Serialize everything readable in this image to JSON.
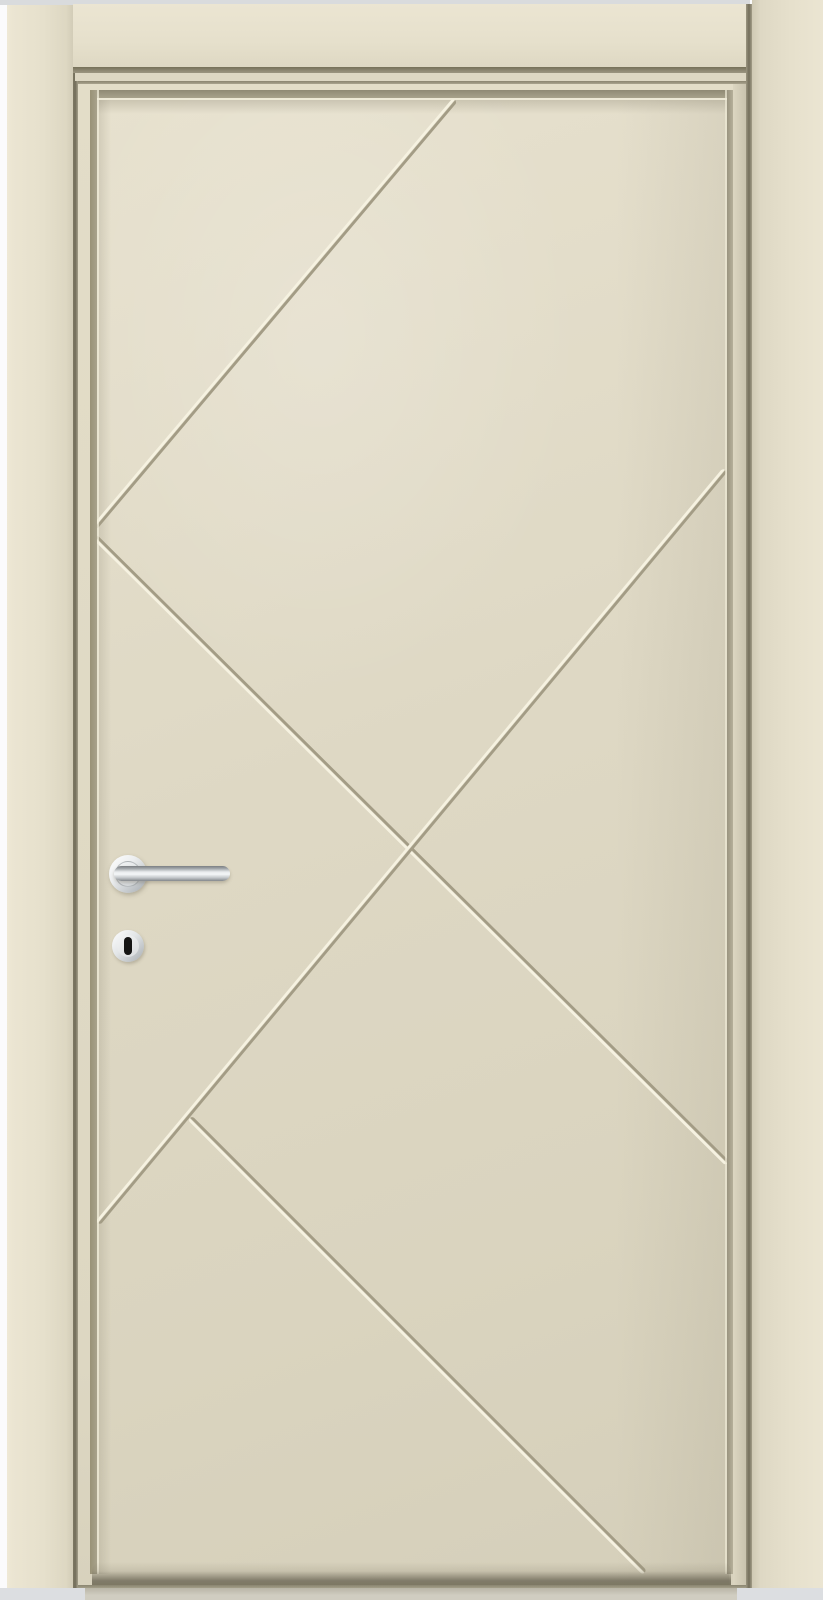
{
  "scene": {
    "description": "Closed ivory-cream painted interior door in matching frame, decorated with incised diagonal V-grooves forming an X pattern, fitted with a round-rose stainless steel lever handle and a round keyhole escutcheon",
    "door_style": "flush slab with recessed field and diagonal pantograph grooves",
    "colors": {
      "background": "#fbfbfc",
      "top_strip": "#d9dbdd",
      "floor_strip": "#dcdee1",
      "floor_under_door": "#d0cdc1",
      "frame_cream": "#e6e0cc",
      "frame_cream_light": "#ebe5d2",
      "frame_cream_dark": "#d2ccb7",
      "door_border": "#e3ddc8",
      "panel_light": "#e7e1ce",
      "panel_mid": "#ded8c4",
      "panel_dark": "#d5cfba",
      "shadow_olive": "#8c8671",
      "seam_dark": "#736e5b",
      "groove_dark": "#a39c85",
      "groove_light": "#f6f2e1",
      "steel_bright": "#f4f6f7",
      "steel_mid": "#c3c8cb",
      "steel_dark": "#7b7f83",
      "keyhole_slot": "#151515"
    },
    "grooves": {
      "width_px": 6,
      "lines": [
        {
          "name": "upper-diagonal",
          "x1": 455,
          "y1": 100,
          "x2": 95,
          "y2": 527
        },
        {
          "name": "main-diagonal",
          "x1": 95,
          "y1": 537,
          "x2": 727,
          "y2": 1163
        },
        {
          "name": "counter-diagonal",
          "x1": 725,
          "y1": 470,
          "x2": 98,
          "y2": 1223
        },
        {
          "name": "lower-diagonal",
          "x1": 190,
          "y1": 1118,
          "x2": 645,
          "y2": 1573
        }
      ],
      "cross_point": {
        "x": 411,
        "y": 850
      }
    },
    "hardware": {
      "finish": "brushed stainless steel",
      "lever_rose_center": {
        "x": 128,
        "y": 874
      },
      "keyhole_center": {
        "x": 128,
        "y": 946
      }
    }
  }
}
